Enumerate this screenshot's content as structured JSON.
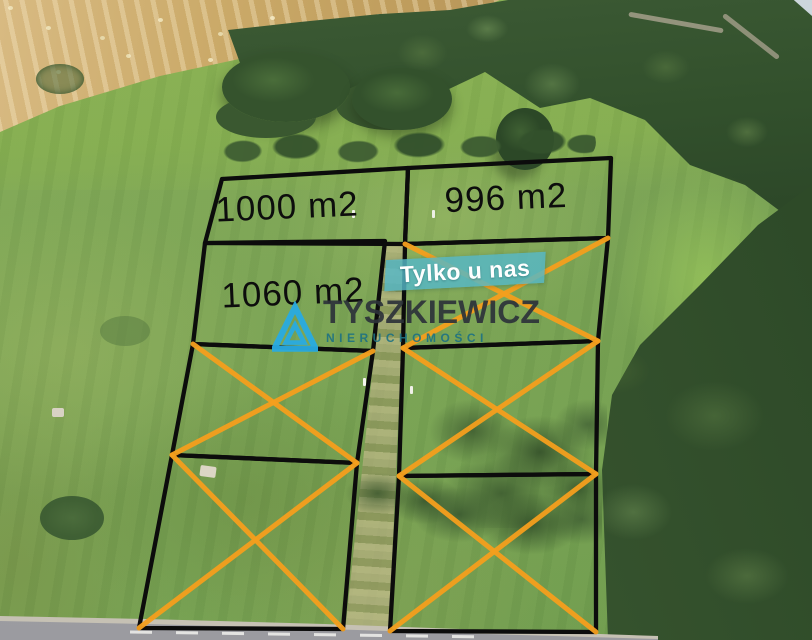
{
  "photo": {
    "type": "aerial-drone-photo",
    "scene": "green meadow building plots bordered by forest, wheat field and asphalt road"
  },
  "badge": {
    "label": "Tylko u nas",
    "background_color": "#56b7c7",
    "text_color": "#ffffff"
  },
  "logo": {
    "icon": "triangle-mountain-icon",
    "icon_color": "#29abe2",
    "name": "TYSZKIEWICZ",
    "name_color": "#2c3239",
    "subtitle": "NIERUCHOMOŚCI",
    "subtitle_color": "#1d7183"
  },
  "styles": {
    "boundary_color": "#0c0c0c",
    "sold_cross_color": "#F59F1D",
    "area_label_color": "#0d0d0d"
  },
  "scenery_colors": {
    "grass": "#7aa355",
    "wheat_field": "#c9a96b",
    "forest": "#33502c",
    "road": "#a2a2a7",
    "dirt_path": "#a79f78"
  },
  "plots": [
    {
      "id": "top-left",
      "area_label": "1000 m2",
      "area_m2": 1000,
      "status": "available",
      "points": [
        [
          222,
          179
        ],
        [
          408,
          168
        ],
        [
          405,
          244
        ],
        [
          205,
          243
        ]
      ],
      "label_pos": [
        287,
        207
      ]
    },
    {
      "id": "top-right",
      "area_label": "996 m2",
      "area_m2": 996,
      "status": "available",
      "points": [
        [
          408,
          168
        ],
        [
          611,
          158
        ],
        [
          608,
          238
        ],
        [
          405,
          244
        ]
      ],
      "label_pos": [
        506,
        198
      ]
    },
    {
      "id": "mid-left",
      "area_label": "1060 m2",
      "area_m2": 1060,
      "status": "available",
      "points": [
        [
          205,
          243
        ],
        [
          385,
          241
        ],
        [
          373,
          351
        ],
        [
          193,
          344
        ]
      ],
      "label_pos": [
        293,
        293
      ]
    },
    {
      "id": "left-row3",
      "status": "sold",
      "points": [
        [
          193,
          344
        ],
        [
          373,
          351
        ],
        [
          357,
          463
        ],
        [
          172,
          455
        ]
      ]
    },
    {
      "id": "left-row4",
      "status": "sold",
      "points": [
        [
          172,
          455
        ],
        [
          357,
          463
        ],
        [
          343,
          629
        ],
        [
          139,
          628
        ]
      ]
    },
    {
      "id": "right-row2",
      "status": "sold",
      "points": [
        [
          405,
          244
        ],
        [
          608,
          238
        ],
        [
          598,
          341
        ],
        [
          403,
          348
        ]
      ]
    },
    {
      "id": "right-row3",
      "status": "sold",
      "points": [
        [
          403,
          348
        ],
        [
          598,
          341
        ],
        [
          596,
          474
        ],
        [
          399,
          476
        ]
      ]
    },
    {
      "id": "right-row4",
      "status": "sold",
      "points": [
        [
          399,
          476
        ],
        [
          596,
          474
        ],
        [
          596,
          632
        ],
        [
          390,
          631
        ]
      ]
    }
  ]
}
